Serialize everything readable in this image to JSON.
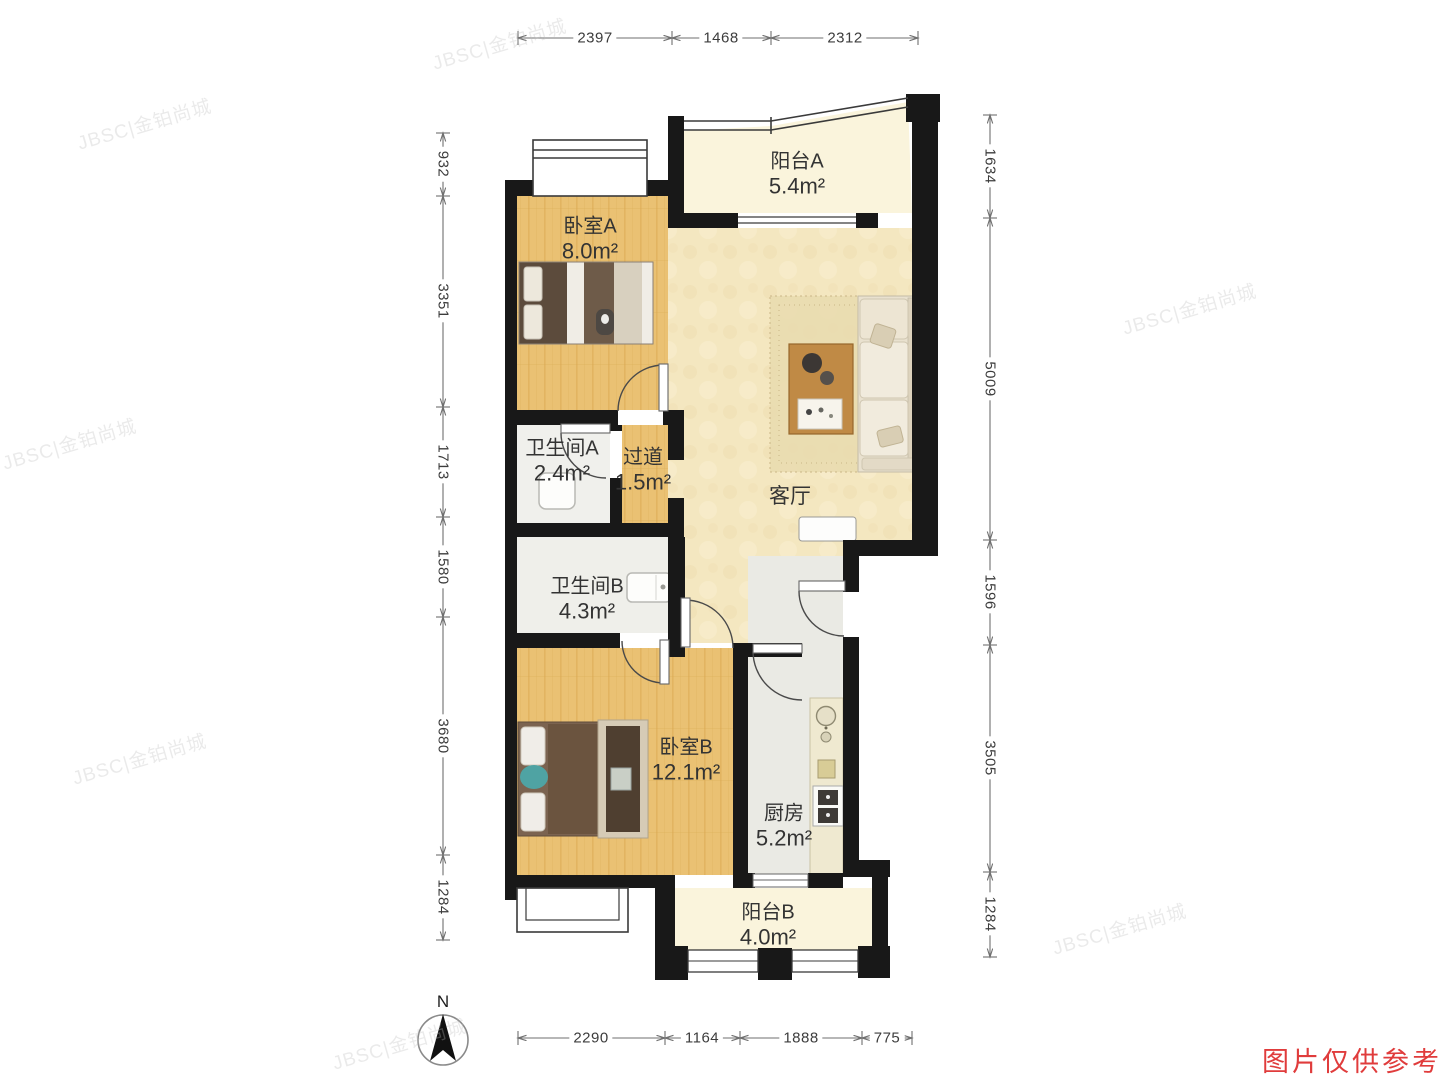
{
  "floorplan": {
    "compass_label": "N",
    "watermark_diagonal": "JBSC|金铂尚城",
    "watermark_notice": "图片仅供参考",
    "rooms": [
      {
        "name": "阳台A",
        "area": "5.4m²"
      },
      {
        "name": "卧室A",
        "area": "8.0m²"
      },
      {
        "name": "卫生间A",
        "area": "2.4m²"
      },
      {
        "name": "过道",
        "area": "1.5m²"
      },
      {
        "name": "客厅",
        "area": ""
      },
      {
        "name": "卫生间B",
        "area": "4.3m²"
      },
      {
        "name": "卧室B",
        "area": "12.1m²"
      },
      {
        "name": "厨房",
        "area": "5.2m²"
      },
      {
        "name": "阳台B",
        "area": "4.0m²"
      }
    ],
    "dimensions": {
      "top": [
        "2397",
        "1468",
        "2312"
      ],
      "left": [
        "932",
        "3351",
        "1713",
        "1580",
        "3680",
        "1284"
      ],
      "right": [
        "1634",
        "5009",
        "1596",
        "3505",
        "1284"
      ],
      "bottom": [
        "2290",
        "1164",
        "1888",
        "775"
      ]
    }
  }
}
